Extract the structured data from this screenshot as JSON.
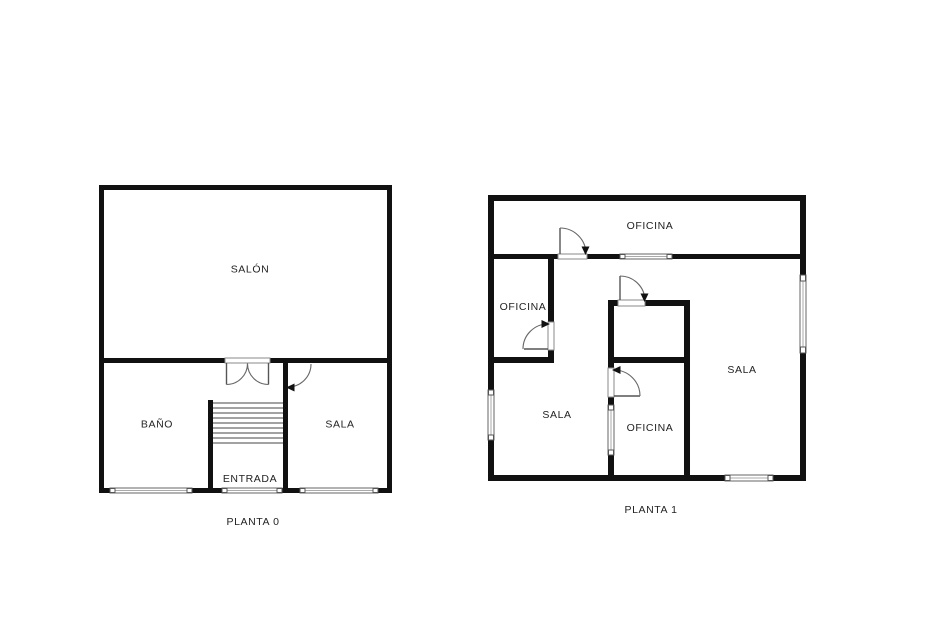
{
  "plans": {
    "planta0": {
      "caption": "PLANTA 0",
      "rooms": {
        "salon": "SALÓN",
        "bano": "BAÑO",
        "sala": "SALA",
        "entrada": "ENTRADA"
      }
    },
    "planta1": {
      "caption": "PLANTA 1",
      "rooms": {
        "oficina_top": "OFICINA",
        "oficina_left": "OFICINA",
        "sala_left": "SALA",
        "oficina_middle": "OFICINA",
        "sala_right": "SALA"
      }
    }
  },
  "colors": {
    "wall": "#111111",
    "door_arc": "#666666",
    "text": "#222222"
  }
}
